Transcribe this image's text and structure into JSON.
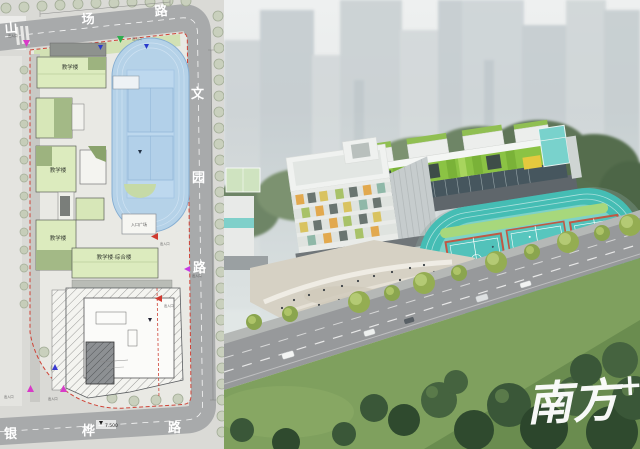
{
  "site_plan": {
    "roads": {
      "top": {
        "name": "山场路",
        "chars": [
          "山",
          "场",
          "路"
        ]
      },
      "right": {
        "name": "文园路",
        "chars": [
          "文",
          "园",
          "路"
        ]
      },
      "bottom": {
        "name": "银桦路",
        "chars": [
          "银",
          "桦",
          "路"
        ]
      }
    },
    "buildings": [
      {
        "label": "教学楼"
      },
      {
        "label": "教学楼"
      },
      {
        "label": "教学楼"
      },
      {
        "label": "教学楼·综合楼"
      }
    ],
    "plaza_label": "入口广场",
    "elevation_marker": "7.500",
    "entrances": [
      {
        "label": "出入口",
        "color": "#d83ac8"
      },
      {
        "label": "出入口",
        "color": "#2fae4e"
      },
      {
        "label": "出入口",
        "color": "#cf3a30"
      },
      {
        "label": "出入口",
        "color": "#cf3a30"
      },
      {
        "label": "出入口",
        "color": "#c63ae2"
      },
      {
        "label": "出入口",
        "color": "#d83ac8"
      },
      {
        "label": "出入口",
        "color": "#3a3ad0"
      }
    ]
  },
  "rendering": {
    "watermark": {
      "text": "南方",
      "plus": "+"
    }
  },
  "colors": {
    "plan_road": "#a8aaab",
    "plan_parcel": "#e9e9e4",
    "plan_field_blue": "#b5d2e8",
    "plan_building_green": "#dcebbe",
    "boundary_red": "#cf4438",
    "render_track_teal": "#45bdb4",
    "facade_green": "#8bc344",
    "foreground_tree_green": "#3a5738",
    "watermark_white": "#ffffff"
  }
}
